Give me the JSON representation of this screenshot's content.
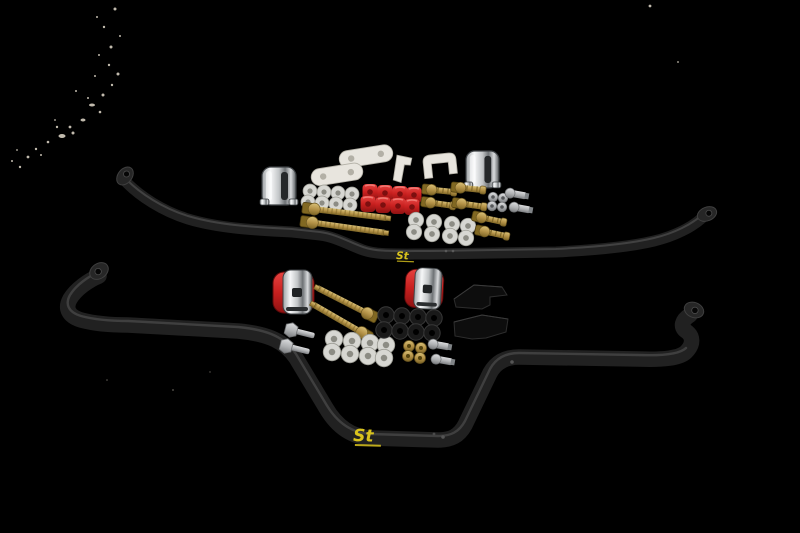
{
  "bars": {
    "top": {
      "logo_text": "St"
    },
    "bottom": {
      "logo_text": "St"
    }
  },
  "colors": {
    "bg": "#000000",
    "bar": "#212121",
    "barhi": "#474747",
    "yellow": "#d9c31d",
    "white": "#e8e5de",
    "whitedark": "#b3b0a6",
    "red": "#c8201f",
    "reddark": "#7c0f0f",
    "gold": "#b59348",
    "golddark": "#816822",
    "goldlite": "#d8c078",
    "silver": "#b7b9ba",
    "silverdark": "#808487",
    "chrome": "#f4f5f6",
    "chromedark": "#74787b",
    "clear": "#d7d7d2",
    "clearhole": "#8c8c84",
    "rubber": "#191919",
    "rubberhi": "#383838",
    "block": "#0d0d0d",
    "blockedge": "#2d2d2d",
    "speck": "#d7d0c1"
  }
}
